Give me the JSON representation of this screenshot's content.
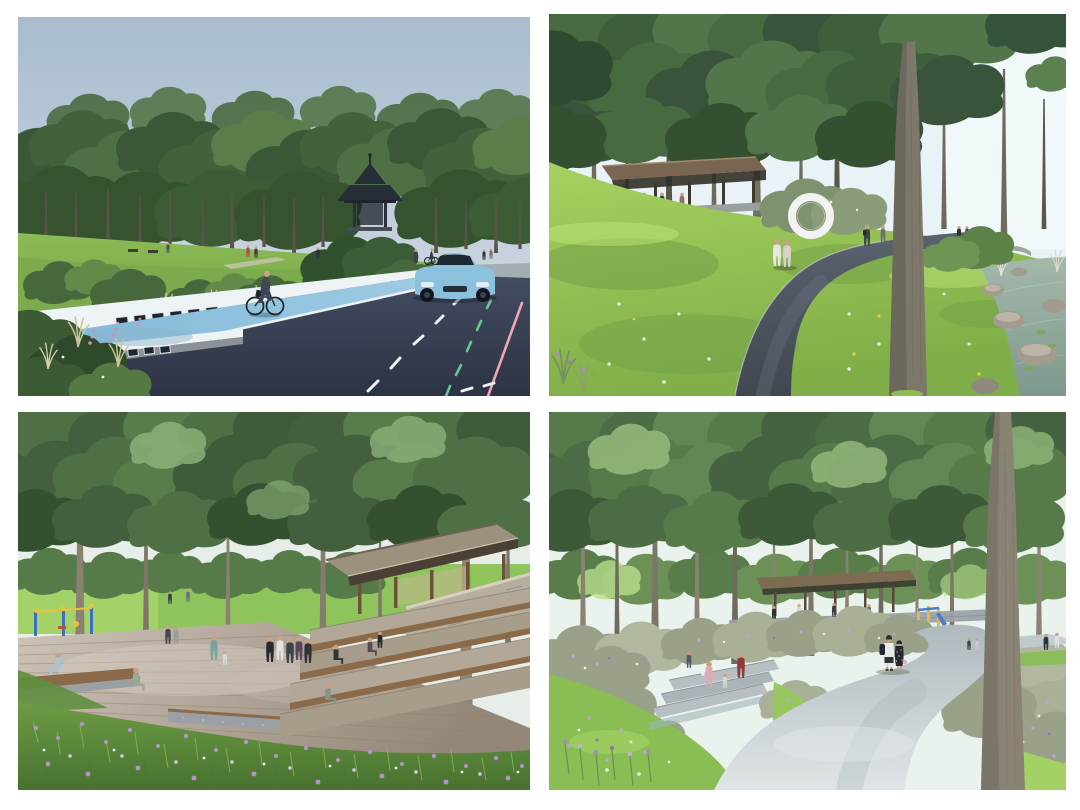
{
  "page": {
    "background": "#ffffff",
    "title": "Forest park landscape design renderings, 2x2 collage",
    "grid": "2 columns x 2 rows of rendered perspective views"
  },
  "panels": {
    "road_greenway": {
      "label": "road-greenway-rendering",
      "description": "Perspective rendering of a street with a sky-blue cycle lane, a cyclist, a light blue car on dark asphalt with green and pink lane lines, a low white park wall with stone base, flowering green slopes, a dense tree line and a dark hexagonal gazebo.",
      "colors": {
        "sky_top": "#a8bccf",
        "sky_bottom": "#ccd6e0",
        "canopy": "#44613c",
        "canopy_dark": "#36522f",
        "canopy_light": "#5d814b",
        "grass_top": "#8cbb55",
        "grass_bottom": "#6f9f43",
        "shrub": "#3c5a34",
        "wall_white": "#eef3f6",
        "stone_base": "#8d9298",
        "block_dark": "#20262e",
        "cycle_lane": "#7db8d8",
        "cycle_lane_light": "#a3cde4",
        "asphalt_top": "#434d60",
        "asphalt_bottom": "#2c3344",
        "entrance_paving": "#a3adb4",
        "line_white": "#eef2f5",
        "line_green": "#66c98e",
        "line_pink": "#f0a6b2",
        "car_body": "#8cc1de",
        "car_glass": "#1e2833",
        "gazebo": "#252d37",
        "flower_pink": "#d78fae"
      }
    },
    "forest_walk": {
      "label": "forest-walk-rendering",
      "description": "Rendering of a dark asphalt footpath curving across a bright lawn under tall slender trees, with a timber shelter on the left hill, a white ring sculpture, strolling visitors, and a rocky stream with reeds and lily pads on the right.",
      "colors": {
        "sky": "#e9f3f7",
        "sky_bright": "#f1f8fa",
        "canopy": "#486a41",
        "canopy_dark": "#39543a",
        "canopy_light": "#5c8150",
        "grass_light": "#a7d15f",
        "grass": "#7fae48",
        "grass_shade": "#6f9c45",
        "path_top": "#5a636e",
        "path_bottom": "#3f474f",
        "path_edge": "#c8cdd2",
        "pavilion_roof": "#7a6650",
        "pavilion_shadow": "#312f26",
        "ring_white": "#f1f2f1",
        "water_top": "#a4b8ac",
        "water_bottom": "#7e998c",
        "rock": "#a29b8e",
        "reed": "#dcd8c4",
        "trunk": "#6e6b5d",
        "trunk_large": "#7d786a"
      }
    },
    "deck_plaza": {
      "label": "deck-plaza-rendering",
      "description": "Rendering of a wooden deck plaza beneath a tree canopy with visitors standing and sitting, play equipment on the left, a timber pavilion with stone wall and terraced timber-and-stone steps on the right, and a purple wildflower meadow in the foreground.",
      "colors": {
        "sky": "#e7eee9",
        "canopy": "#4e7044",
        "canopy_dark": "#3f5c3a",
        "canopy_light": "#8fb57d",
        "lawn": "#8fc45c",
        "deck_light": "#cdc3b7",
        "deck_dark": "#948778",
        "plank_line": "#8d8273",
        "pavilion_roof": "#9c917f",
        "pavilion_underside": "#4b4034",
        "post_wood": "#6b5138",
        "stone_wall": "#b6ae9e",
        "step_stone": "#b3a897",
        "bench_wood": "#8a6a49",
        "gabion": "#9aa0a4",
        "meadow_top": "#6d9c44",
        "meadow_bottom": "#47722f",
        "grass_blade": "#86b556",
        "flower_purple": "#b793cc",
        "flower_light": "#d9c6ea",
        "flower_white": "#f0ecf4",
        "playground_blue": "#3a6fc4",
        "playground_yellow": "#e8c23f",
        "trunk": "#8a8172"
      }
    },
    "winding_path": {
      "label": "winding-path-rendering",
      "description": "Rendering of a light concrete path winding through a forest meadow of grey-green shrubs with purple and white blossoms, a strolling couple with a backpack and polka-dot dress, stone steps with a family on the left, a background pavilion, stone wall walkway and yellow play equipment.",
      "colors": {
        "sky": "#eaf2ee",
        "canopy": "#567a49",
        "canopy_dark": "#466341",
        "canopy_light": "#96bb7d",
        "back_foliage": "#587c4a",
        "backlit": "#b8df8a",
        "grass": "#8abd53",
        "grass_light": "#a3d164",
        "meadow": "#99a289",
        "meadow_light": "#b0b89e",
        "flower_purple": "#b9a6cf",
        "flower_deep": "#8d79a8",
        "flower_white": "#eef1ea",
        "path_bottom": "#e0e5e7",
        "path_top": "#aeb9bd",
        "steps": "#b8bfc2",
        "stone_wall": "#9aa3a6",
        "pavilion_roof": "#7d6b52",
        "playground_yellow": "#e5b93e",
        "playground_blue": "#4a7dc8",
        "trunk": "#8a8374",
        "figure_pink": "#e4a9b0",
        "dress_black": "#26292d",
        "shirt_white": "#e9eaea"
      }
    }
  }
}
